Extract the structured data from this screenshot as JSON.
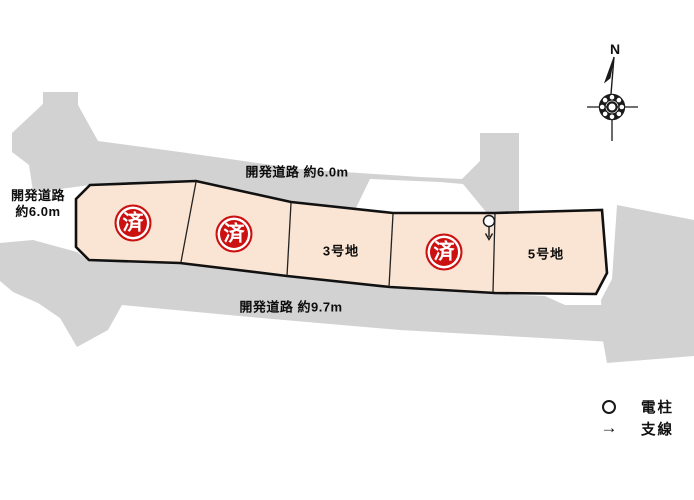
{
  "roads": {
    "color": "#d2d2d2",
    "top_label": "開発道路 約6.0m",
    "bottom_label": "開発道路 約9.7m",
    "left_label_line1": "開発道路",
    "left_label_line2": "約6.0m"
  },
  "plots": {
    "fill_color": "#fae4d3",
    "stamp_color": "#cc1111",
    "items": [
      {
        "label": "1号地",
        "sold": true,
        "stamp": "済"
      },
      {
        "label": "2号地",
        "sold": true,
        "stamp": "済"
      },
      {
        "label": "3号地",
        "sold": false
      },
      {
        "label": "4号地",
        "sold": true,
        "stamp": "済"
      },
      {
        "label": "5号地",
        "sold": false
      }
    ]
  },
  "compass": {
    "north_label": "N"
  },
  "legend": {
    "arrow_glyph": "→",
    "items": [
      {
        "label": "電柱"
      },
      {
        "label": "支線"
      }
    ]
  }
}
